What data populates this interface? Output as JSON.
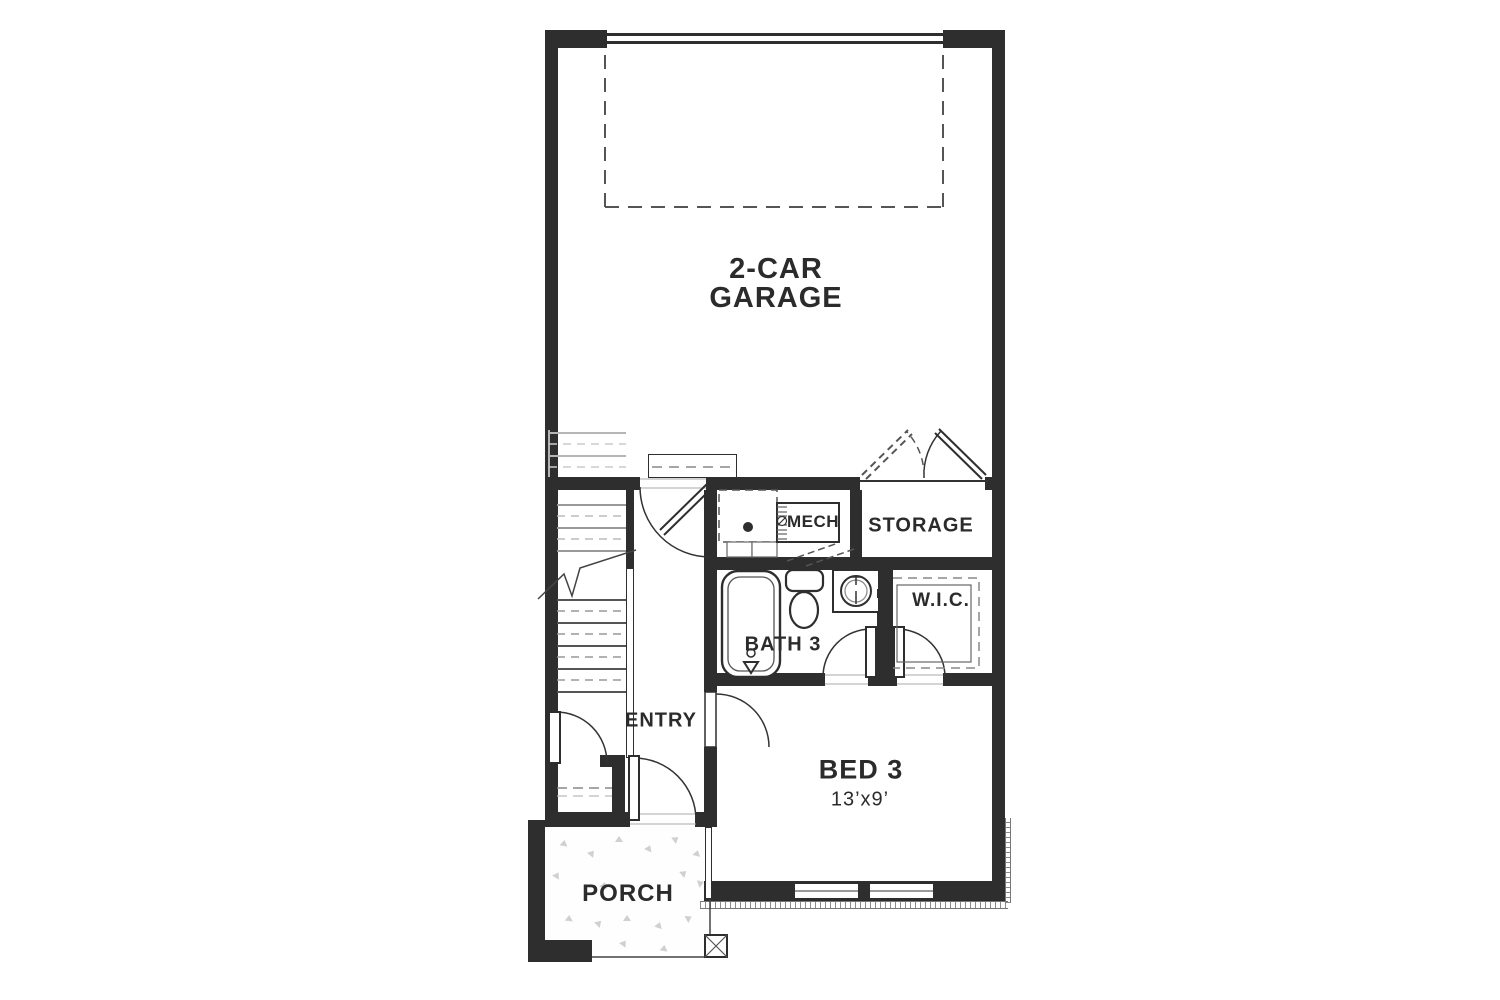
{
  "floorplan": {
    "rooms": {
      "garage": {
        "label_line1": "2-CAR",
        "label_line2": "GARAGE"
      },
      "mech": {
        "label": "MECH"
      },
      "storage": {
        "label": "STORAGE"
      },
      "bath3": {
        "label": "BATH 3"
      },
      "wic": {
        "label": "W.I.C."
      },
      "entry": {
        "label": "ENTRY"
      },
      "bed3": {
        "label": "BED 3",
        "dimensions": "13’x9’"
      },
      "porch": {
        "label": "PORCH"
      }
    },
    "fixtures": {
      "garage": [
        "garage-door",
        "overhead-door-clearance",
        "entry-stoop",
        "storage-double-doors",
        "stair-ghost-treads"
      ],
      "mech": [
        "water-heater",
        "appliance-space",
        "floor-drain",
        "bifold-door"
      ],
      "bath3": [
        "bathtub",
        "toilet",
        "sink-vanity"
      ],
      "wic": [
        "closet-shelving",
        "swing-door"
      ],
      "entry": [
        "staircase-with-break-line",
        "coat-closet",
        "front-door"
      ],
      "bed3": [
        "two-windows",
        "swing-door"
      ],
      "porch": [
        "support-column",
        "concrete-texture"
      ]
    },
    "colors": {
      "wall": "#2e2e2e",
      "text": "#2b2b2b",
      "light_line": "#999999",
      "background": "#ffffff"
    }
  }
}
